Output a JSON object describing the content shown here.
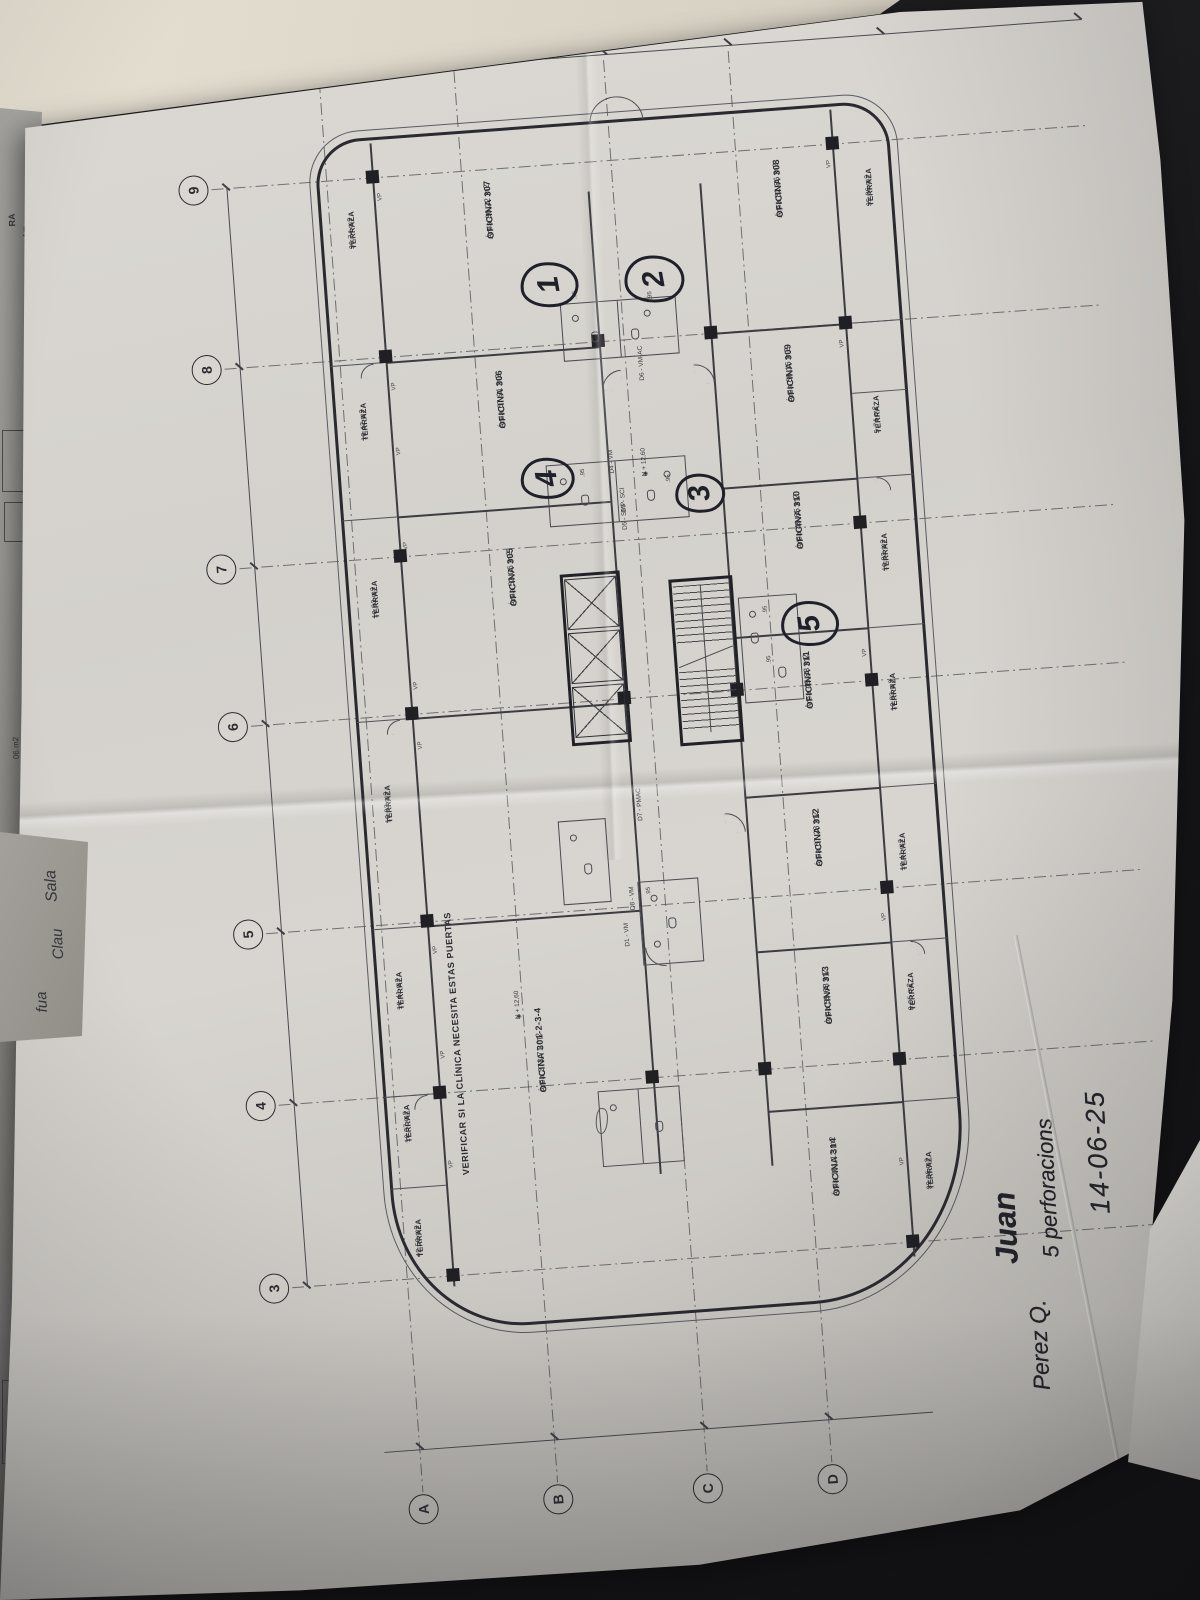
{
  "symbols": {
    "level_diamond": "◈"
  },
  "plan": {
    "grid_rows": [
      "9",
      "8",
      "7",
      "6",
      "5",
      "4",
      "3"
    ],
    "grid_cols": [
      "A",
      "B",
      "C",
      "D"
    ],
    "offices": [
      {
        "name": "OFICINA 307",
        "area": "Área 86,22 m2"
      },
      {
        "name": "OFICINA 306",
        "area": "Área 67,91 m2"
      },
      {
        "name": "OFICINA 305",
        "area": "Área 53,06 m2"
      },
      {
        "name": "OFICINA 301-2-3-4",
        "area": "Área 273,71 m2"
      },
      {
        "name": "OFICINA 308",
        "area": "Área 82,86 m2"
      },
      {
        "name": "OFICINA 309",
        "area": "Área 66,16 m2"
      },
      {
        "name": "OFICINA 310",
        "area": "Área 49,65 m2"
      },
      {
        "name": "OFICINA 311",
        "area": "Área 45,88 m2"
      },
      {
        "name": "OFICINA 312",
        "area": "Área 67,28 m2"
      },
      {
        "name": "OFICINA 313",
        "area": "Área 55,68 m2"
      },
      {
        "name": "OFICINA 314",
        "area": "Área 101,12 m2"
      }
    ],
    "terraces_left": [
      {
        "name": "TERRAZA",
        "area": "36,74 m2"
      },
      {
        "name": "TERRAZA",
        "area": "10,42 m2"
      },
      {
        "name": "TERRAZA",
        "area": "10,93 m2"
      },
      {
        "name": "TERRAZA",
        "area": "10,93 m2"
      },
      {
        "name": "TERRAZA",
        "area": "10,41 m2"
      },
      {
        "name": "TERRAZA",
        "area": "10,37 m2"
      },
      {
        "name": "TERRAZA",
        "area": "42,50 m2"
      }
    ],
    "terraces_right": [
      {
        "name": "TERRAZA",
        "area": "35,36 m2"
      },
      {
        "name": "TERRAZA",
        "area": "5,74 m2"
      },
      {
        "name": "TERRAZA",
        "area": "10,93 m2"
      },
      {
        "name": "TERRAZA",
        "area": "10,93 m2"
      },
      {
        "name": "TERRAZA",
        "area": "10,41 m2"
      },
      {
        "name": "TERRAZA",
        "area": "8,05 m2"
      },
      {
        "name": "TERRAZA",
        "area": "39,36 m2"
      }
    ],
    "door_labels": [
      "D1 - VM",
      "D2 - VM",
      "D3 - SCI",
      "D4 - VM",
      "D5 - SMP",
      "D6 - VM-AC",
      "D7 - PMAC",
      "D8 - VM"
    ],
    "level_mark": "N + 12,60",
    "window_label": "VP",
    "dim_small": ".95",
    "note": "VERIFICAR SI LA CLÍNICA NECESITA ESTAS PUERTAS",
    "markup_circles": [
      "1",
      "2",
      "3",
      "4",
      "5"
    ]
  },
  "handwriting": {
    "date": "14-06-25",
    "note": "5 perforacions",
    "scribble": "Perez Q.",
    "signature": "Juan",
    "signature2": "Juan Q."
  },
  "side_sheet": {
    "fragments": [
      "RA",
      "4 m",
      "06 m2"
    ],
    "cursive": [
      "Sala",
      "Clau",
      "fua"
    ]
  }
}
